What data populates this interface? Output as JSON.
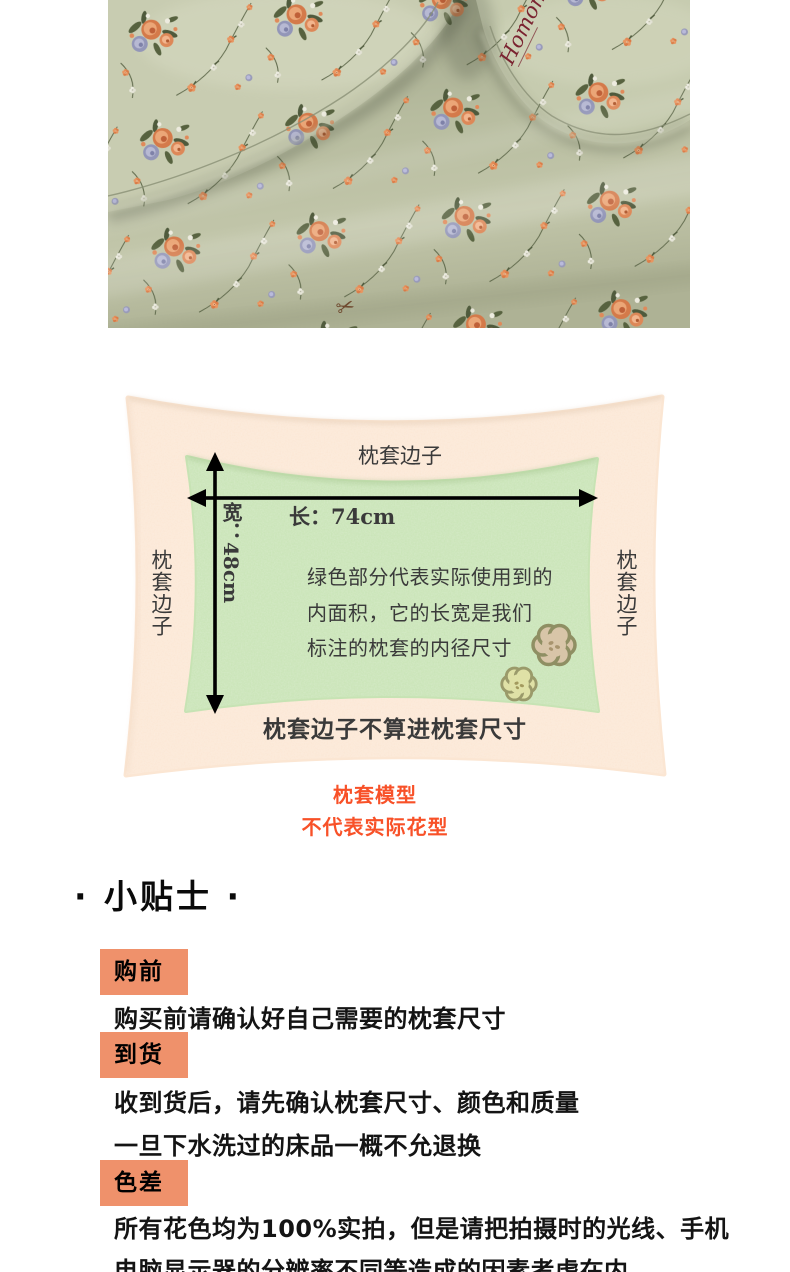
{
  "photo": {
    "description": "sage-green floral bedding, two flanged pillows on a sheet",
    "brand_logo": "Homon",
    "scissors_glyph": "✂",
    "colors": {
      "fabric": "#b4b89c",
      "pillow": "#c8ccb1",
      "coral_flower": "#dd8454",
      "lavender_flower": "#9496b8",
      "leaf": "#4f5a3c"
    }
  },
  "diagram": {
    "top_edge_label": "枕套边子",
    "left_edge_label": "枕套边子",
    "right_edge_label": "枕套边子",
    "length_label": "长：74cm",
    "width_label": "宽：48cm",
    "description_lines": {
      "0": "绿色部分代表实际使用到的",
      "1": "内面积，它的长宽是我们",
      "2": "标注的枕套的内径尺寸"
    },
    "bottom_note": "枕套边子不算进枕套尺寸",
    "caption_line1": "枕套模型",
    "caption_line2": "不代表实际花型",
    "colors": {
      "cover": "#fbe6d3",
      "inner_area": "#c7e3b4",
      "caption_text": "#f85128",
      "arrow": "#000000"
    }
  },
  "tips": {
    "title": "· 小贴士 ·",
    "badge_color": "#ef916b",
    "items": {
      "0": {
        "badge": "购前",
        "line1": "购买前请确认好自己需要的枕套尺寸"
      },
      "1": {
        "badge": "到货",
        "line1": "收到货后，请先确认枕套尺寸、颜色和质量",
        "line2": "一旦下水洗过的床品一概不允退换"
      },
      "2": {
        "badge": "色差",
        "line1": "所有花色均为100%实拍，但是请把拍摄时的光线、手机",
        "line2": "电脑显示器的分辨率不同等造成的因素考虑在内"
      }
    }
  }
}
